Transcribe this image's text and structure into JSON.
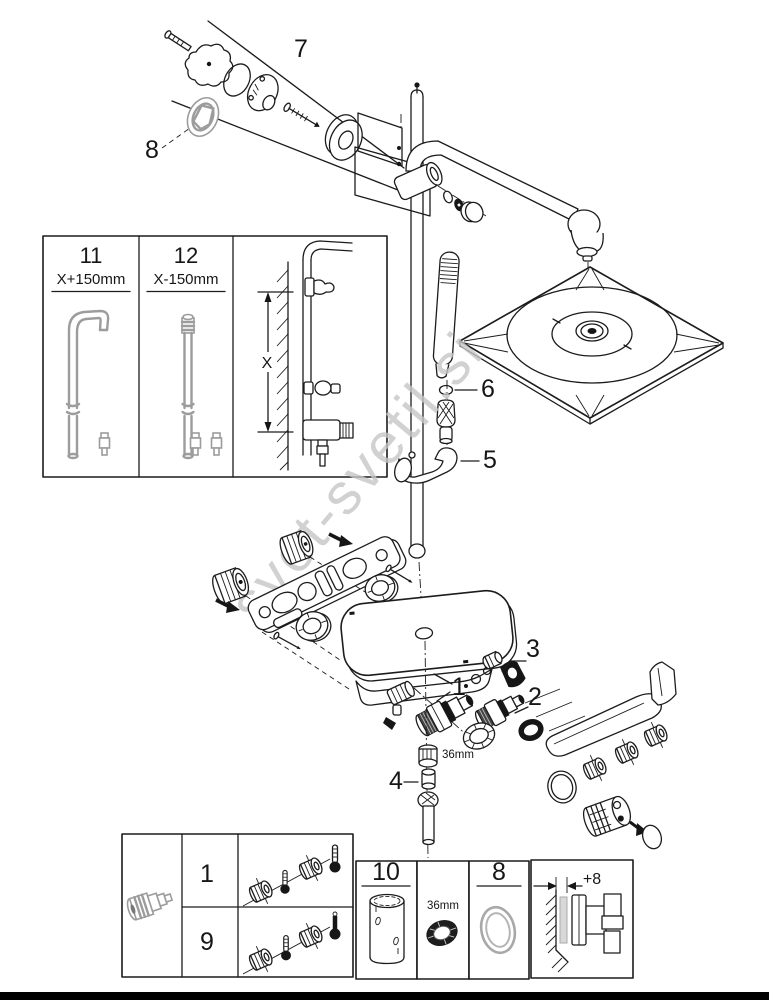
{
  "page": {
    "watermark": "svet-svetil.si",
    "callouts": {
      "part1": "1",
      "part2": "2",
      "part3": "3",
      "part4": "4",
      "part5": "5",
      "part6": "6",
      "part7": "7",
      "part8": "8"
    },
    "labels": {
      "size_36mm_center": "36mm"
    },
    "inset_box": {
      "col1_number": "11",
      "col1_dimension": "X+150mm",
      "col2_number": "12",
      "col2_dimension": "X-150mm",
      "height_dimension": "X"
    },
    "bottom_left_box": {
      "row1_number": "1",
      "row2_number": "9"
    },
    "bottom_cells": {
      "cell_10_number": "10",
      "cell_36mm": "36mm",
      "cell_8_number": "8",
      "wall_offset": "+8"
    },
    "colors": {
      "line": "#1c1c1c",
      "gray_part": "#9c9c9c",
      "watermark": "#c6c6c6",
      "black_bar": "#000000"
    }
  }
}
